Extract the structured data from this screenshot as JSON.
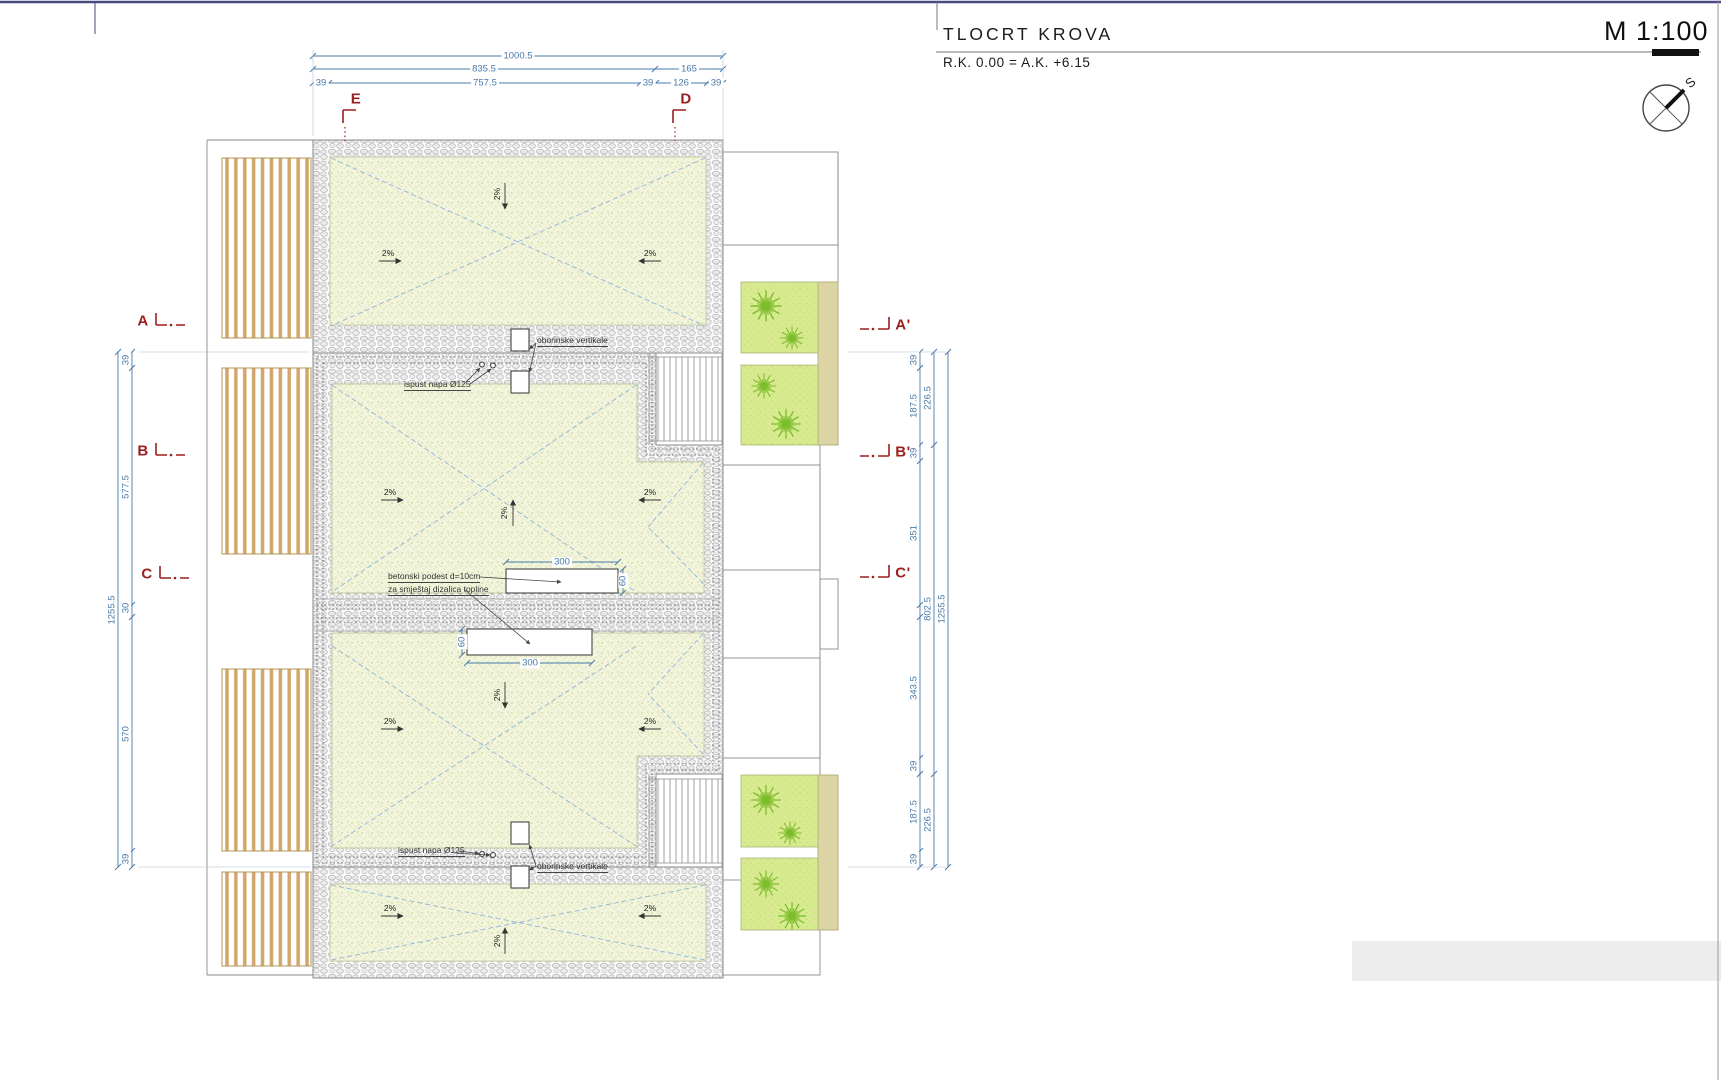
{
  "sheet": {
    "title": "TLOCRT KROVA",
    "elevation_note": "R.K. 0.00 = A.K. +6.15",
    "scale": "M 1:100",
    "north": "S"
  },
  "dims": {
    "d1000": "1000.5",
    "d835": "835.5",
    "d165": "165",
    "d757": "757.5",
    "d126": "126",
    "d39": "39",
    "d577": "577.5",
    "d30": "30",
    "d570": "570",
    "d1255": "1255.5",
    "d187": "187.5",
    "d226": "226.5",
    "d351": "351",
    "d343": "343.5",
    "d802": "802.5",
    "d300": "300",
    "d60": "60"
  },
  "markers": {
    "e": "E",
    "d": "D",
    "a": "A",
    "b": "B",
    "c": "C",
    "a2": "A'",
    "b2": "B'",
    "c2": "C'"
  },
  "notes": {
    "drain": "oborinske vertikale",
    "outlet": "ispust napa Ø125",
    "podest1": "betonski podest d=10cm",
    "podest2": "za smještaj dizalica topline",
    "slope": "2%"
  },
  "colors": {
    "dim_blue": "#4a7aa9",
    "marker_red": "#9b1f1f",
    "roof_stipple": "#f2f5dc",
    "grass_green": "#d8ea90",
    "plant_green": "#7dbd2c",
    "wood_tan": "#d1a66a",
    "sheet_border": "#4a4a82"
  }
}
